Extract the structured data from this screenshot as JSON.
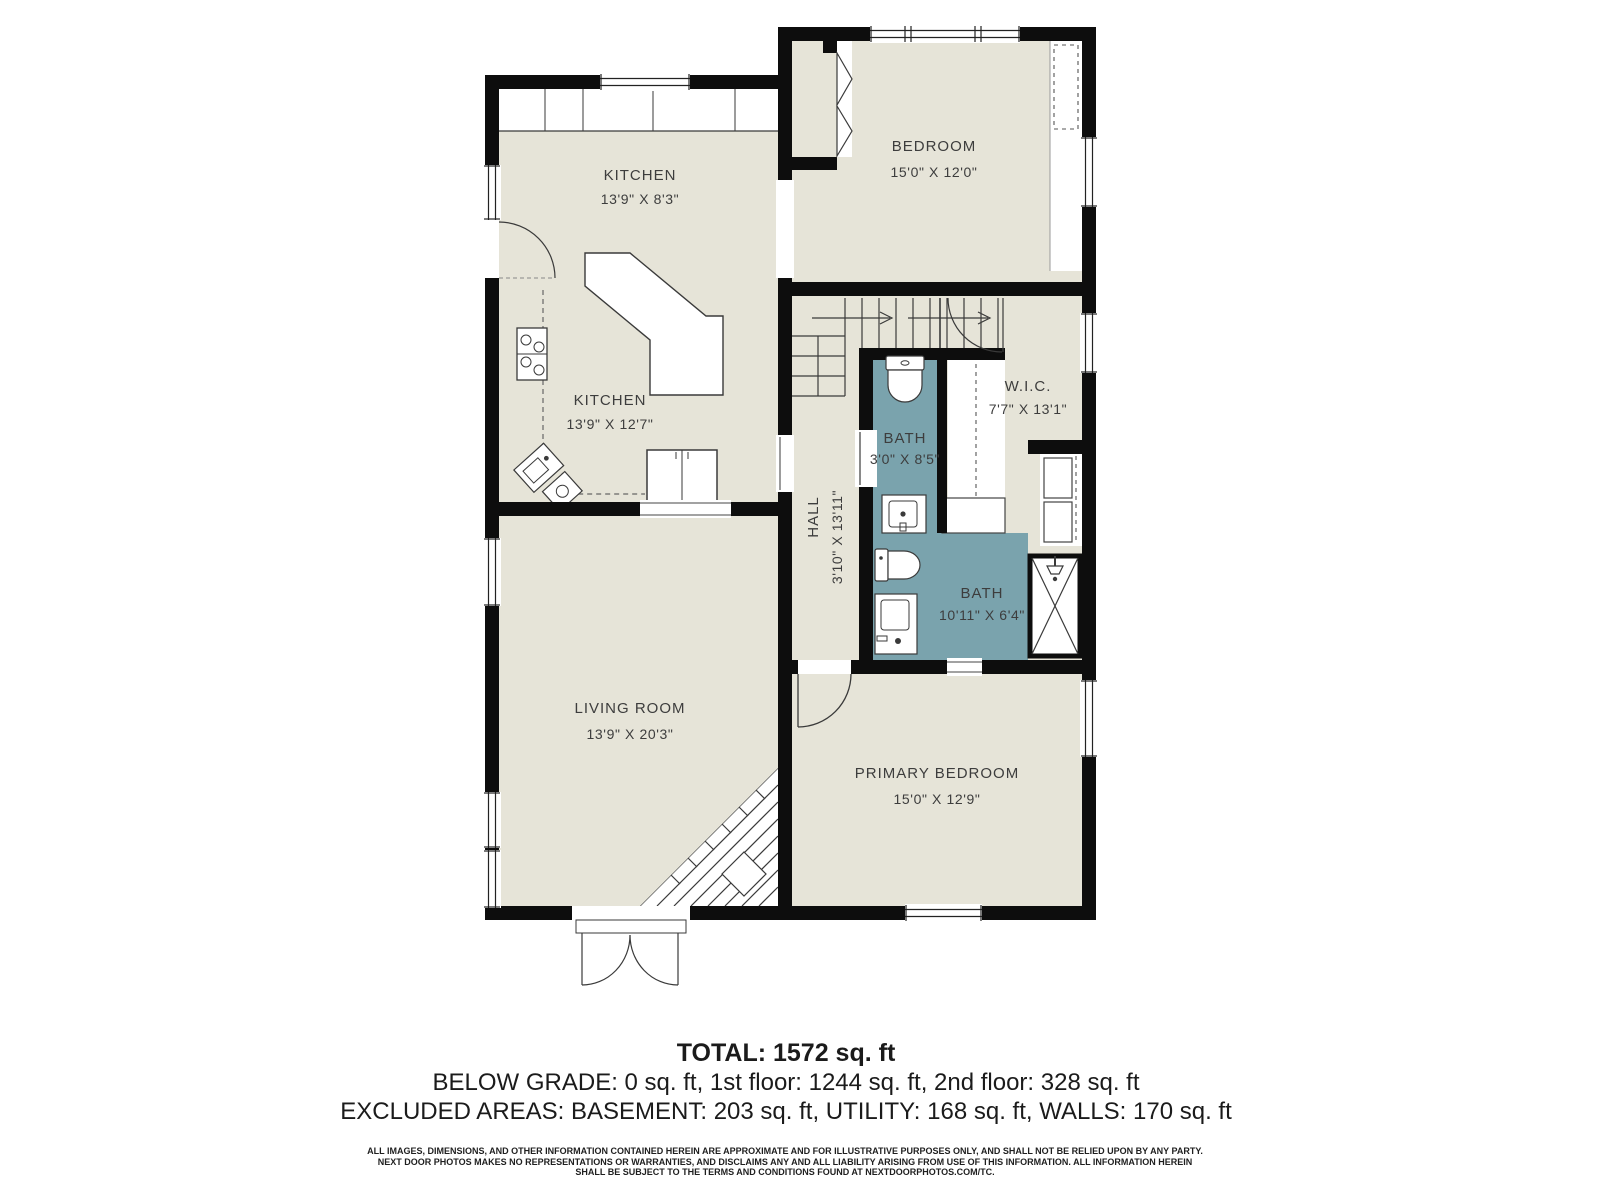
{
  "colors": {
    "room_fill": "#e6e4d8",
    "bath_fill": "#7aa3ad",
    "wall": "#0d0d0d",
    "label": "#3d3d3d"
  },
  "rooms": {
    "kitchen_top": {
      "name": "KITCHEN",
      "dims": "13'9\" X 8'3\""
    },
    "bedroom": {
      "name": "BEDROOM",
      "dims": "15'0\" X 12'0\""
    },
    "kitchen_main": {
      "name": "KITCHEN",
      "dims": "13'9\" X 12'7\""
    },
    "wic": {
      "name": "W.I.C.",
      "dims": "7'7\" X 13'1\""
    },
    "hall": {
      "name": "HALL",
      "dims": "3'10\" X 13'11\""
    },
    "bath_small": {
      "name": "BATH",
      "dims": "3'0\" X 8'5\""
    },
    "bath_main": {
      "name": "BATH",
      "dims": "10'11\" X 6'4\""
    },
    "living_room": {
      "name": "LIVING ROOM",
      "dims": "13'9\" X 20'3\""
    },
    "primary_bedroom": {
      "name": "PRIMARY BEDROOM",
      "dims": "15'0\" X 12'9\""
    }
  },
  "summary": {
    "total": "TOTAL: 1572 sq. ft",
    "floors": "BELOW GRADE: 0 sq. ft, 1st floor: 1244 sq. ft, 2nd floor: 328 sq. ft",
    "excluded": "EXCLUDED AREAS: BASEMENT: 203 sq. ft, UTILITY: 168 sq. ft, WALLS: 170 sq. ft"
  },
  "disclaimer": {
    "line1": "ALL IMAGES, DIMENSIONS, AND OTHER INFORMATION CONTAINED HEREIN ARE APPROXIMATE AND FOR ILLUSTRATIVE PURPOSES ONLY, AND SHALL NOT BE RELIED UPON BY ANY PARTY.",
    "line2": "NEXT DOOR PHOTOS MAKES NO REPRESENTATIONS OR WARRANTIES, AND DISCLAIMS ANY AND ALL LIABILITY ARISING FROM USE OF THIS INFORMATION. ALL INFORMATION HEREIN",
    "line3": "SHALL BE SUBJECT TO THE TERMS AND CONDITIONS FOUND AT NEXTDOORPHOTOS.COM/TC."
  }
}
